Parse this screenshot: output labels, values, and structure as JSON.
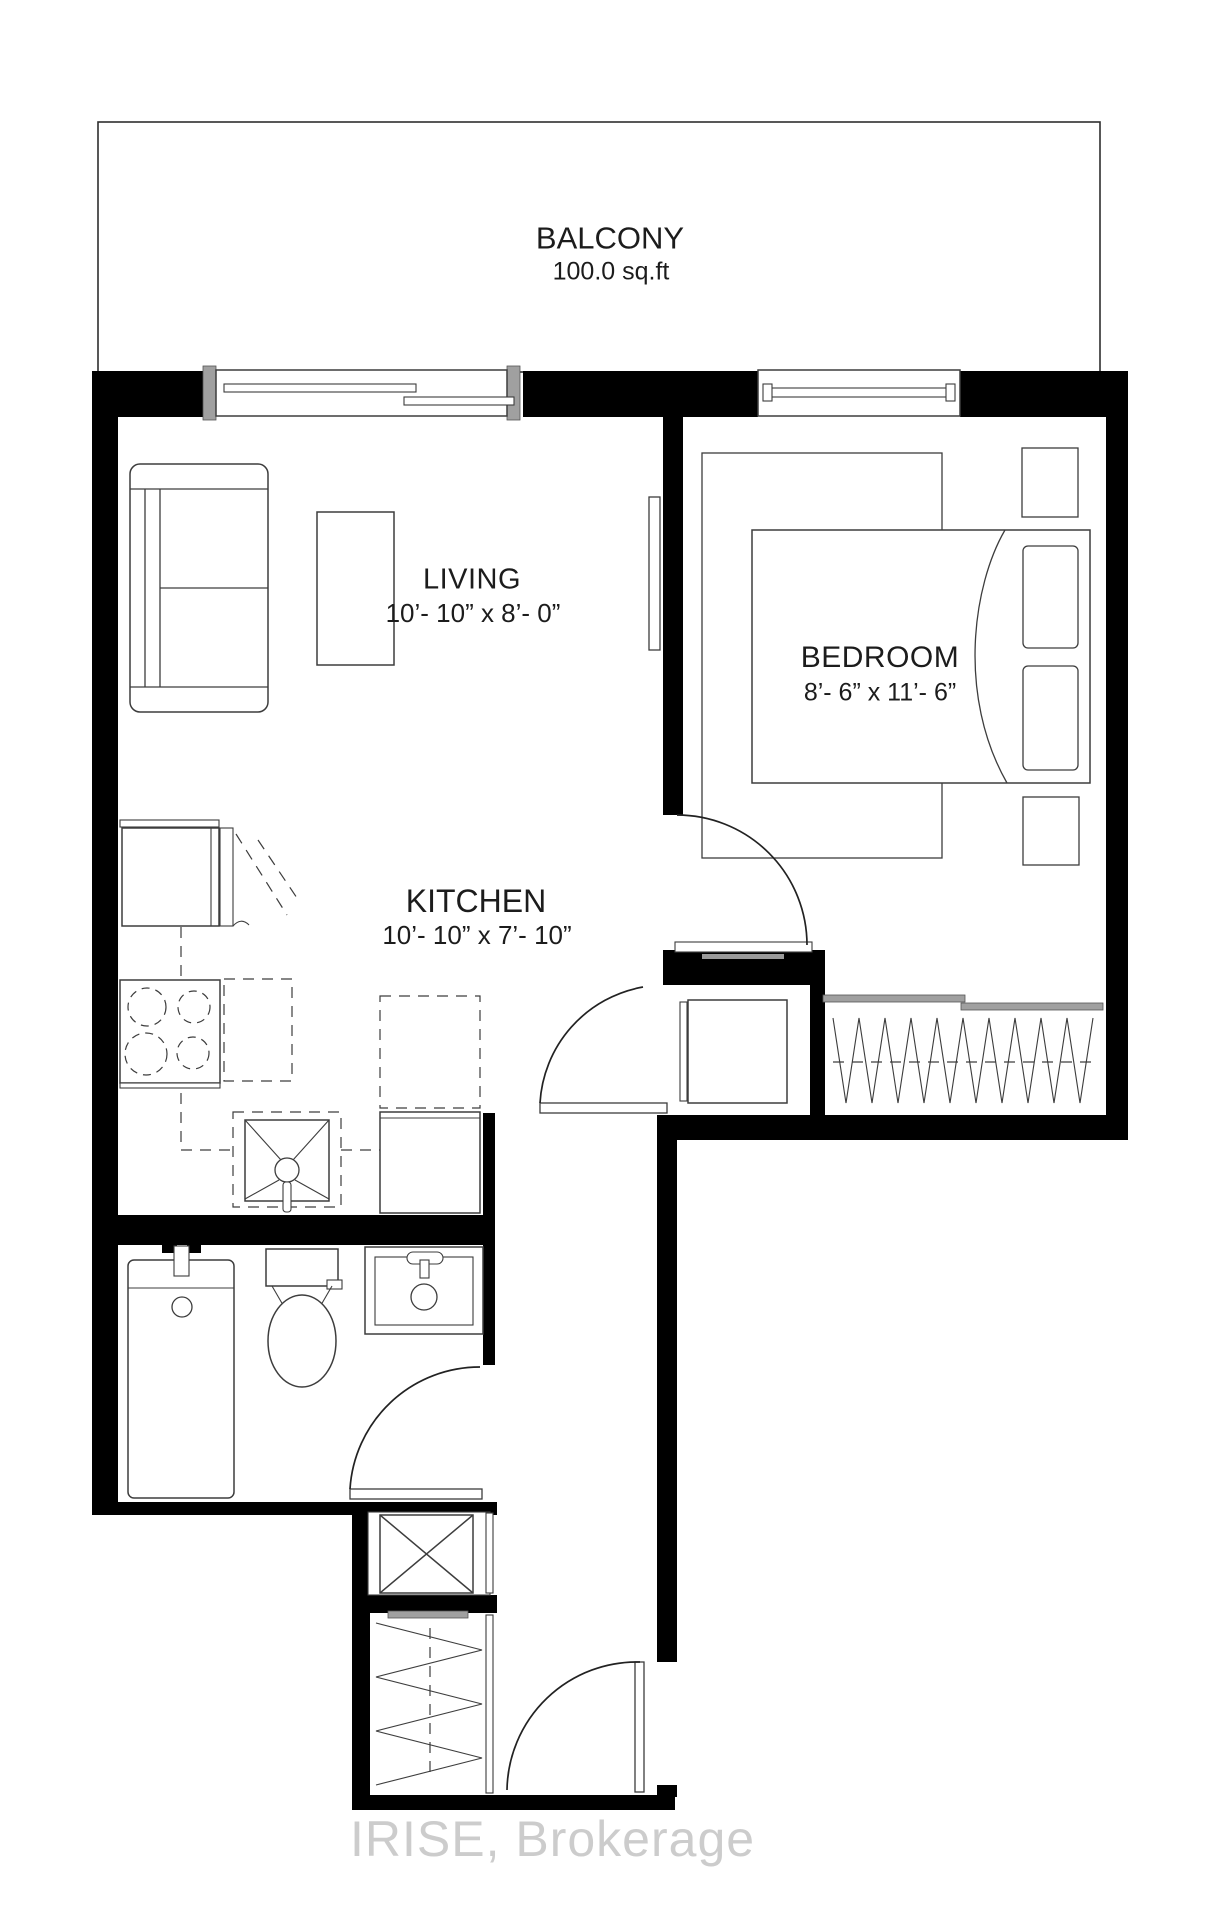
{
  "rooms": {
    "balcony": {
      "name": "BALCONY",
      "area": "100.0 sq.ft"
    },
    "living": {
      "name": "LIVING",
      "dimensions": "10’- 10” x 8’- 0”"
    },
    "kitchen": {
      "name": "KITCHEN",
      "dimensions": "10’- 10” x 7’- 10”"
    },
    "bedroom": {
      "name": "BEDROOM",
      "dimensions": "8’- 6” x 11’- 6”"
    }
  },
  "watermark": {
    "text": "IRISE, Brokerage"
  },
  "colors": {
    "walls": "#000000",
    "lines": "#3d3d3d",
    "watermark": "#c8c8c8",
    "background": "#ffffff"
  }
}
